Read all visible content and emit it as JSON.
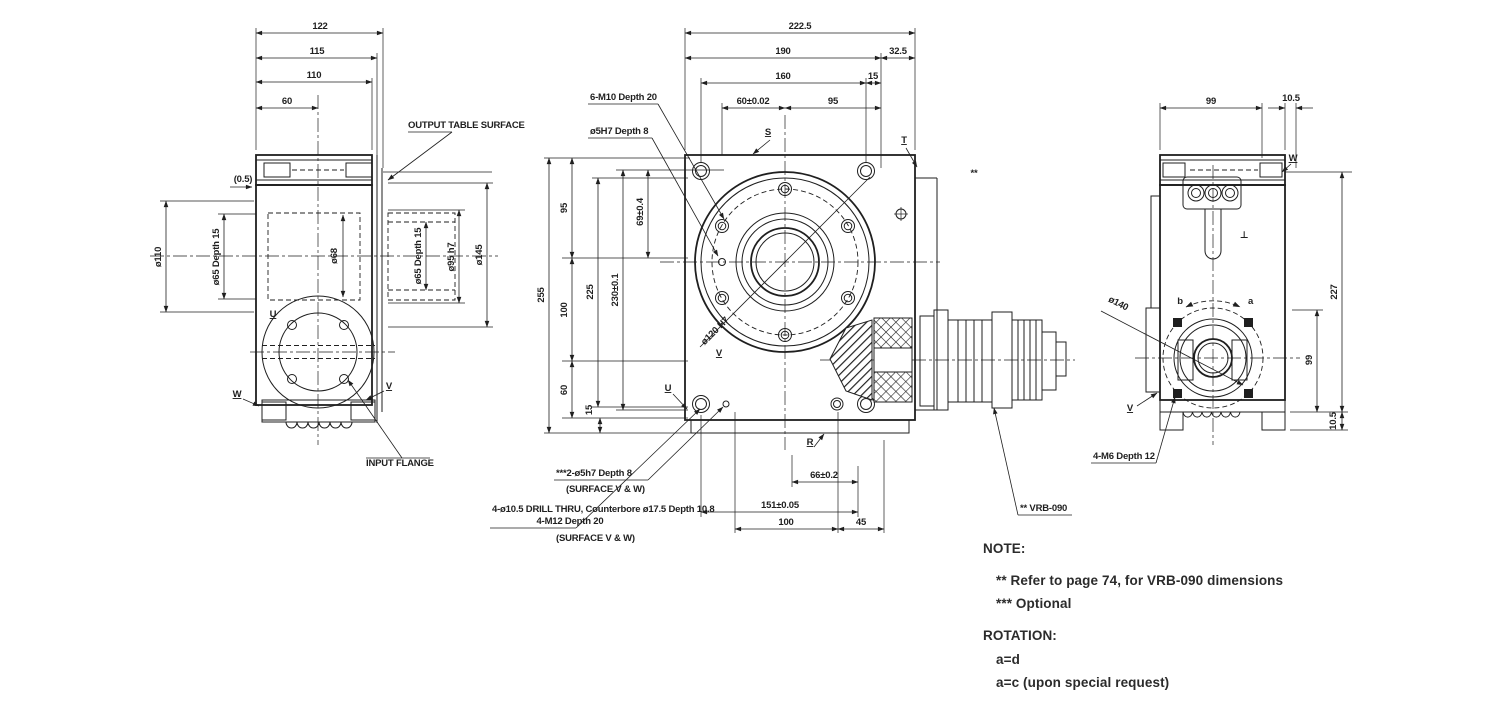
{
  "colors": {
    "ink": "#1f1f1f",
    "background": "#ffffff"
  },
  "left_view": {
    "dims": {
      "w122": "122",
      "w115": "115",
      "w110": "110",
      "w60": "60",
      "gap": "(0.5)",
      "dia110": "ø110",
      "dia65_left": "ø65  Depth 15",
      "dia68": "ø68",
      "dia65_right": "ø65  Depth 15",
      "dia95": "ø95 h7",
      "dia145": "ø145"
    },
    "labels": {
      "output_table_surface": "OUTPUT TABLE SURFACE",
      "input_flange": "INPUT FLANGE",
      "surface_u": "U",
      "surface_w": "W",
      "surface_v": "V"
    }
  },
  "front_view": {
    "dims": {
      "w2225": "222.5",
      "w190": "190",
      "w325": "32.5",
      "w160": "160",
      "w15": "15",
      "w60": "60±0.02",
      "w95": "95",
      "h255": "255",
      "h95": "95",
      "h100": "100",
      "h60": "60",
      "h15": "15",
      "h225": "225",
      "h230": "230±0.1",
      "h69": "69±0.4",
      "bore": "ø120 H7",
      "b66": "66±0.2",
      "b151": "151±0.05",
      "b100": "100",
      "b45": "45"
    },
    "callouts": {
      "m10": "6-M10  Depth 20",
      "pin_top": "ø5H7  Depth 8",
      "pin_bottom": "***2-ø5h7  Depth 8",
      "pin_bottom_note": "(SURFACE V & W)",
      "drill": "4-ø10.5 DRILL THRU, Counterbore ø17.5  Depth 10.8",
      "m12": "4-M12  Depth 20",
      "drill_note": "(SURFACE V & W)",
      "vrb": "** VRB-090",
      "stars": "**"
    },
    "labels": {
      "surface_s": "S",
      "surface_t": "T",
      "surface_u": "U",
      "surface_v": "V",
      "surface_r": "R"
    }
  },
  "right_view": {
    "dims": {
      "w99": "99",
      "w105": "10.5",
      "h227": "227",
      "h99": "99",
      "h105": "10.5",
      "bc140": "ø140"
    },
    "callouts": {
      "m6": "4-M6  Depth 12"
    },
    "labels": {
      "surface_w": "W",
      "surface_v": "V",
      "perp": "⊥",
      "rot_a": "a",
      "rot_b": "b"
    }
  },
  "notes": {
    "heading": "NOTE:",
    "lines": [
      "** Refer to page 74, for VRB-090 dimensions",
      "*** Optional"
    ]
  },
  "rotation": {
    "heading": "ROTATION:",
    "lines": [
      "a=d",
      "a=c (upon special request)"
    ]
  }
}
